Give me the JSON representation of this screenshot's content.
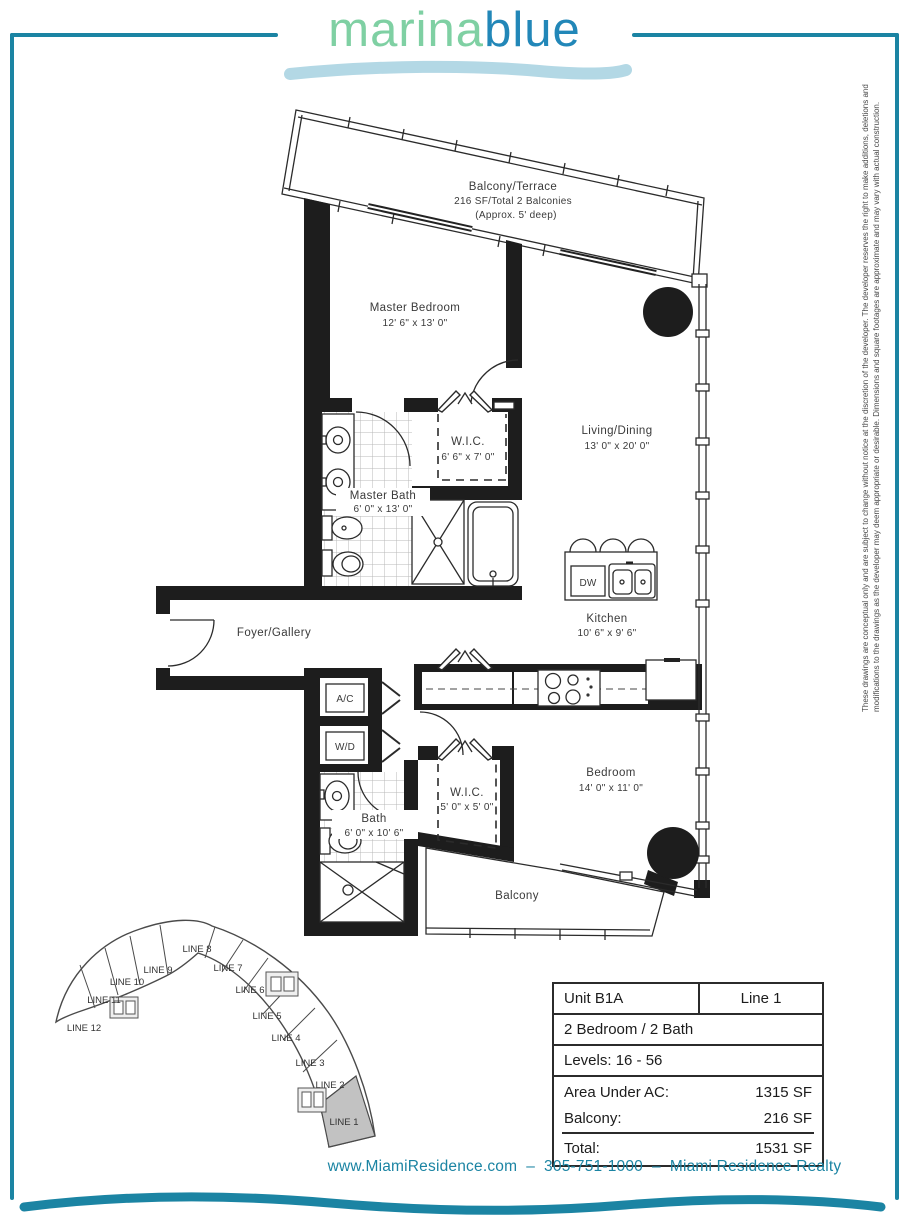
{
  "logo": {
    "part_green": "marina",
    "part_blue": "blue"
  },
  "colors": {
    "accent": "#1b84a3",
    "logo_green": "#7fd0a3",
    "logo_blue": "#2287b8",
    "wave_light": "#b3d8e5",
    "wall_ink": "#1d1d1d",
    "keyplan_highlight": "#c2c2c2"
  },
  "floorplan": {
    "balcony_terrace": {
      "l1": "Balcony/Terrace",
      "l2": "216 SF/Total 2 Balconies",
      "l3": "(Approx. 5' deep)"
    },
    "rooms": {
      "master_bedroom": {
        "name": "Master Bedroom",
        "dims": "12' 6\" x 13' 0\""
      },
      "wic_master": {
        "name": "W.I.C.",
        "dims": "6' 6\" x 7' 0\""
      },
      "master_bath": {
        "name": "Master Bath",
        "dims": "6' 0\" x 13' 0\""
      },
      "living_dining": {
        "name": "Living/Dining",
        "dims": "13' 0\" x 20' 0\""
      },
      "kitchen": {
        "name": "Kitchen",
        "dims": "10' 6\" x 9' 6\""
      },
      "foyer": {
        "name": "Foyer/Gallery"
      },
      "ac": {
        "name": "A/C"
      },
      "wd": {
        "name": "W/D"
      },
      "bath2": {
        "name": "Bath",
        "dims": "6' 0\" x 10' 6\""
      },
      "wic2": {
        "name": "W.I.C.",
        "dims": "5' 0\" x 5' 0\""
      },
      "bedroom2": {
        "name": "Bedroom",
        "dims": "14' 0\" x 11' 0\""
      },
      "balcony2": {
        "name": "Balcony"
      },
      "dishwasher": {
        "name": "DW"
      }
    }
  },
  "keyplan": {
    "highlighted": "LINE 1",
    "lines": [
      "LINE 1",
      "LINE 2",
      "LINE 3",
      "LINE 4",
      "LINE 5",
      "LINE 6",
      "LINE 7",
      "LINE 8",
      "LINE 9",
      "LINE 10",
      "LINE 11",
      "LINE 12"
    ]
  },
  "table": {
    "unit": "Unit B1A",
    "line": "Line 1",
    "bed_bath": "2 Bedroom / 2 Bath",
    "levels": "Levels: 16 - 56",
    "rows": [
      {
        "label": "Area Under AC:",
        "value": "1315 SF"
      },
      {
        "label": "Balcony:",
        "value": "216 SF"
      },
      {
        "label": "Total:",
        "value": "1531 SF"
      }
    ]
  },
  "disclaimer": {
    "line1": "These drawings are conceptual only and are subject to change without notice at the discretion of the developer. The developer reserves the right to make additions, deletions and",
    "line2": "modifications to the drawings as the developer may deem appropriate or desirable. Dimensions and square footages are approximate and may vary with actual construction."
  },
  "footer": {
    "text": "www.MiamiResidence.com  –  305-751-1000  –  Miami Residence Realty"
  }
}
